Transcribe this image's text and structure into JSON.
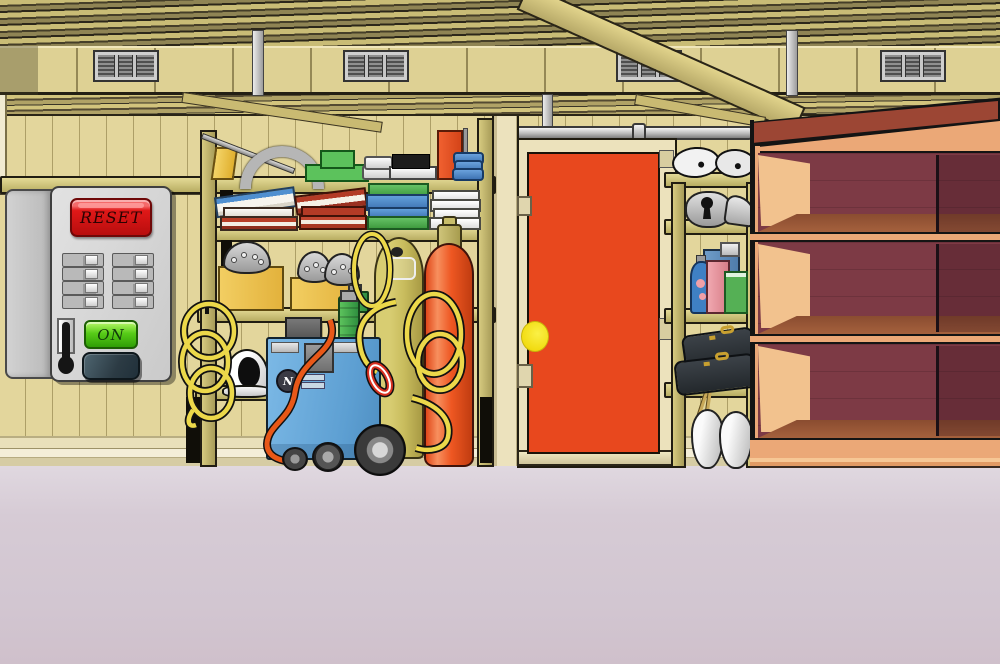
{
  "scene": {
    "name": "garage-room"
  },
  "panel": {
    "reset_label": "RESET",
    "on_label": "ON",
    "switch_count": 8
  },
  "machine": {
    "logo": "N"
  },
  "door": {
    "color": "#e8481e",
    "knob_color": "#f2dc12"
  },
  "colors": {
    "wall": "#e3d69c",
    "floor": "#d5cbd4",
    "shelf_frame": "#c8bc6e",
    "reset_red": "#e01818",
    "on_green": "#58cc18",
    "machine_blue": "#6fb0e0",
    "tank_yellow": "#cdc266",
    "cylinder_orange": "#ee5722",
    "bookcase_frame": "#eba877",
    "bookcase_back": "#7d3a45",
    "bookcase_shelf": "#9c5a3a"
  }
}
